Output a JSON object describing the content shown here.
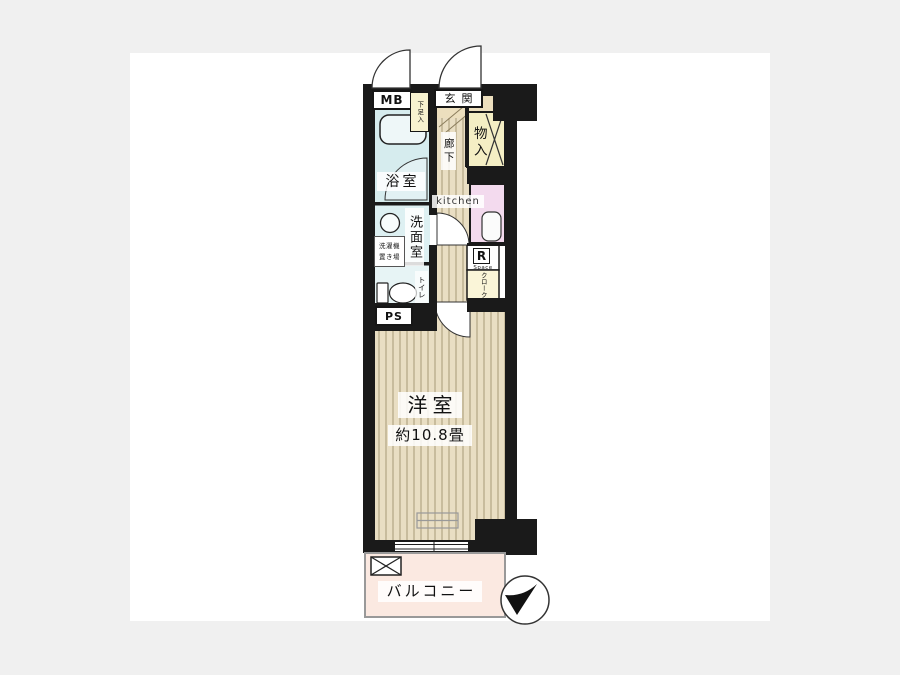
{
  "page": {
    "background_color": "#f0f0f0",
    "canvas_color": "#ffffff"
  },
  "colors": {
    "wall": "#1a1a1a",
    "flooring": "#e9dec3",
    "flooring_stripe": "#b3a584",
    "bathroom": "#d6ecee",
    "washroom": "#ddf0f2",
    "toilet_room": "#e7f4f5",
    "closet_yellow": "#f4eec4",
    "kitchen_counter_pink": "#f3daee",
    "cloak_yellow": "#faf5d8",
    "genkan_floor": "#ecdfbe",
    "balcony_pink": "#fbe9e1"
  },
  "labels": {
    "meter_box": "MB",
    "entrance": "玄関",
    "shoe_storage": "下足入",
    "storage": "物入",
    "hallway": "廊下",
    "kitchen": "kitchen",
    "bathroom": "浴室",
    "washroom": "洗面室",
    "washer_line1": "洗濯機",
    "washer_line2": "置き場",
    "toilet": "トイレ",
    "pipe_space": "PS",
    "refrigerator": "R",
    "refrigerator_sub": "Space",
    "cloak": "クローク",
    "main_room": "洋室",
    "main_room_size": "約10.8畳",
    "balcony": "バルコニー"
  }
}
